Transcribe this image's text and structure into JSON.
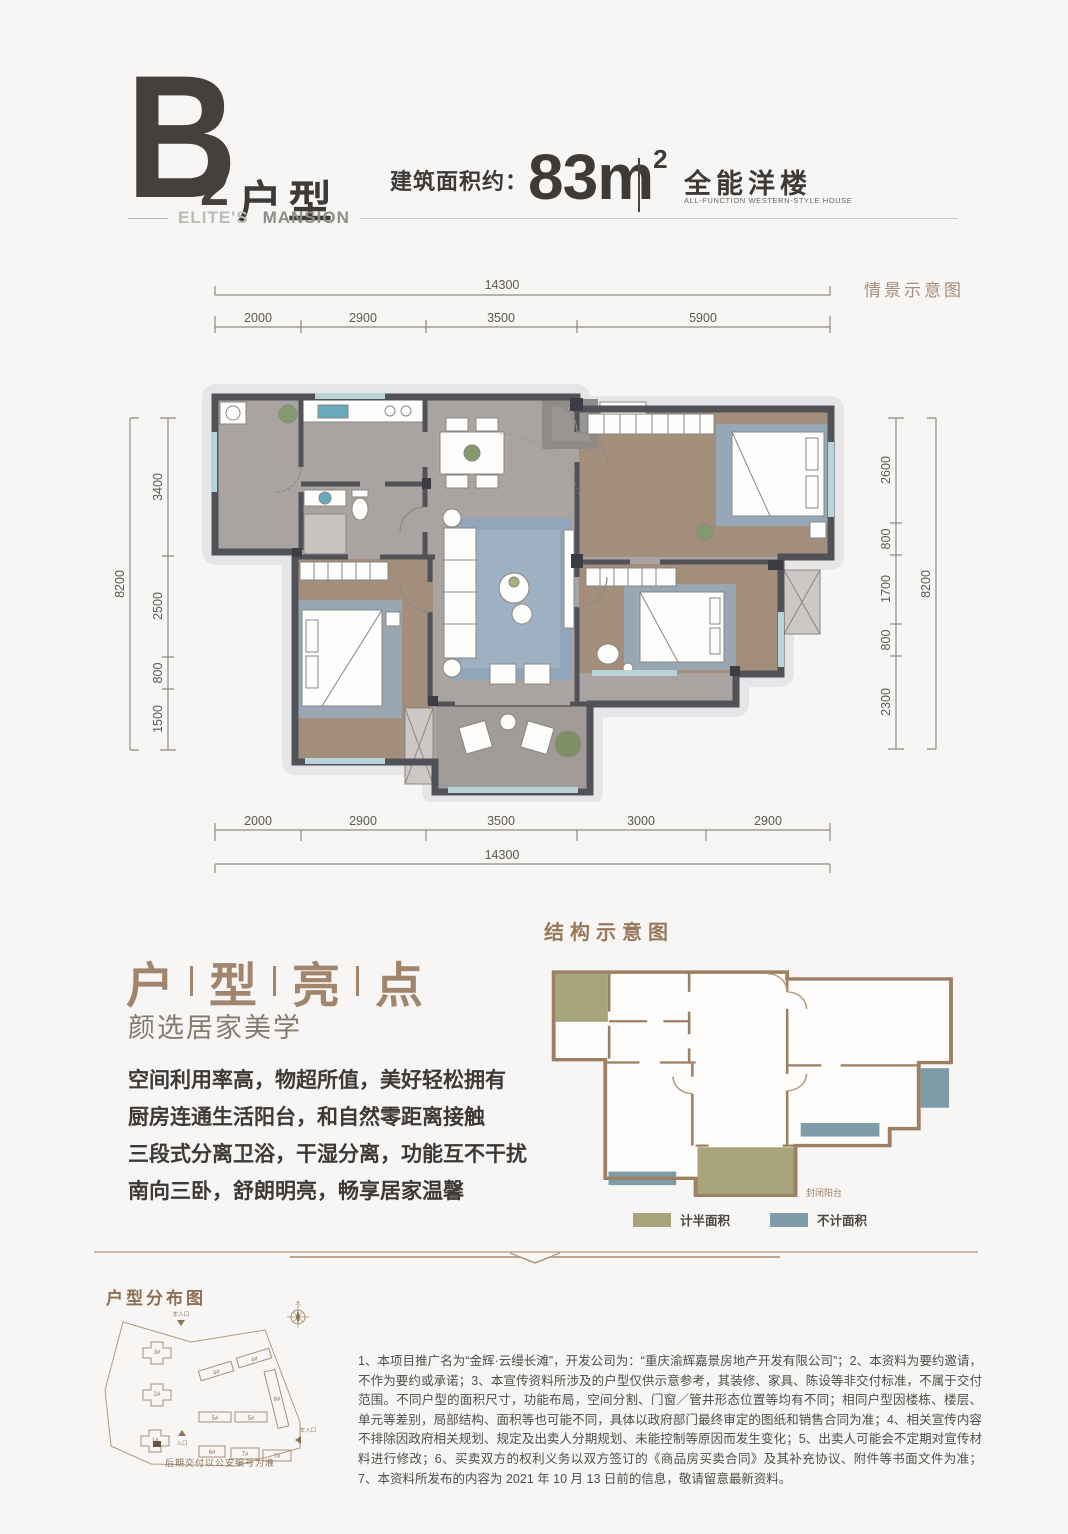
{
  "header": {
    "unit_letter": "B",
    "unit_number": "2",
    "unit_suffix": "户型",
    "area_label": "建筑面积约：",
    "area_value": "83m",
    "area_sup": "2",
    "type_cn": "全能洋楼",
    "type_en": "ALL-FUNCTION WESTERN-STYLE HOUSE",
    "brand_light": "ELITE'S",
    "brand_bold": "MANSION"
  },
  "plan": {
    "scene_label": "情景示意图",
    "dims": {
      "top_total": "14300",
      "top_segments": [
        "2000",
        "2900",
        "3500",
        "5900"
      ],
      "left_total": "8200",
      "left_segments": [
        "3400",
        "2500",
        "800",
        "1500"
      ],
      "right_segments": [
        "2600",
        "800",
        "1700",
        "800",
        "2300"
      ],
      "right_total": "8200",
      "bottom_segments": [
        "2000",
        "2900",
        "3500",
        "3000",
        "2900"
      ],
      "bottom_total": "14300"
    }
  },
  "highlights": {
    "title_chars": [
      "户",
      "型",
      "亮",
      "点"
    ],
    "subtitle": "颜选居家美学",
    "lines": [
      "空间利用率高，物超所值，美好轻松拥有",
      "厨房连通生活阳台，和自然零距离接触",
      "三段式分离卫浴，干湿分离，功能互不干扰",
      "南向三卧，舒朗明亮，畅享居家温馨"
    ]
  },
  "structure": {
    "title": "结构示意图",
    "balcony_label": "封闭阳台",
    "legend": [
      {
        "label": "计半面积",
        "color": "#a8a47b"
      },
      {
        "label": "不计面积",
        "color": "#7e9ca8"
      }
    ]
  },
  "distribution": {
    "title": "户型分布图",
    "caption": "后期交付以公安编号为准",
    "entry_top": "车入口",
    "entry_left": "入口",
    "entry_right": "车入口",
    "north": "北",
    "buildings": [
      "1#",
      "2#",
      "3#",
      "4#",
      "5#",
      "6#",
      "7#",
      "8#"
    ]
  },
  "disclaimer": {
    "text": "1、本项目推广名为“金辉·云缦长滩”，开发公司为：“重庆渝辉嘉景房地产开发有限公司”；2、本资料为要约邀请，不作为要约或承诺；3、本宣传资料所涉及的户型仅供示意参考，其装修、家具、陈设等非交付标准，不属于交付范围。不同户型的面积尺寸，功能布局，空间分割、门窗／管井形态位置等均有不同；相同户型因楼栋、楼层、单元等差别，局部结构、面积等也可能不同，具体以政府部门最终审定的图纸和销售合同为准；4、相关宣传内容不排除因政府相关规划、规定及出卖人分期规划、未能控制等原因而发生变化；5、出卖人可能会不定期对宣传材料进行修改；6、买卖双方的权利义务以双方签订的《商品房买卖合同》及其补充协议、附件等书面文件为准；7、本资料所发布的内容为 2021 年 10 月 13 日前的信息，敬请留意最新资料。"
  },
  "colors": {
    "accent_brown": "#a1856c",
    "olive": "#a8a47b",
    "steel_blue": "#7e9ca8",
    "wall": "#515258",
    "wood_floor": "#a38d7b",
    "stone_floor": "#a9a4a1",
    "rug_blue": "#95abbe",
    "sill_blue": "#b9d3d9"
  }
}
